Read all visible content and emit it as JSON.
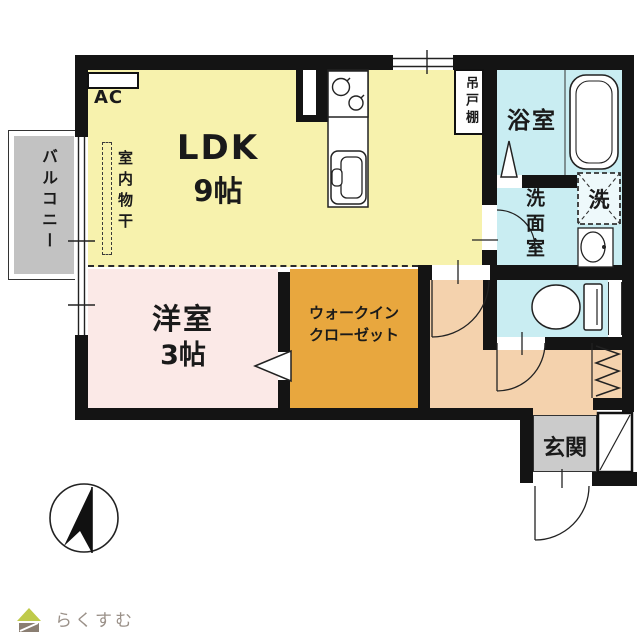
{
  "colors": {
    "ldk": "#f7f2ad",
    "bedroom": "#fbe9e7",
    "wic": "#e8a73e",
    "hallway": "#f4d2ad",
    "wet": "#c9edf2",
    "entrance": "#cbcbcb",
    "balcony": "#c2c2c2",
    "wall": "#141414",
    "logo_green": "#bfca4a",
    "logo_brown": "#8a7e72",
    "logo_text": "#9a9088"
  },
  "rooms": {
    "ldk": {
      "label": "LDK",
      "size": "9帖"
    },
    "bedroom": {
      "label": "洋室",
      "size": "3帖"
    },
    "wic": {
      "line1": "ウォークイン",
      "line2": "クローゼット"
    },
    "balcony": {
      "label": "バルコニー"
    },
    "bathroom": {
      "label": "浴室"
    },
    "washroom": {
      "label": "洗面室"
    },
    "laundry": {
      "label": "洗"
    },
    "entrance": {
      "label": "玄関"
    }
  },
  "fixtures": {
    "ac": "AC",
    "hanging_cupboard": "吊戸棚",
    "indoor_drying": "室内物干"
  },
  "footer": {
    "brand": "らくすむ"
  }
}
